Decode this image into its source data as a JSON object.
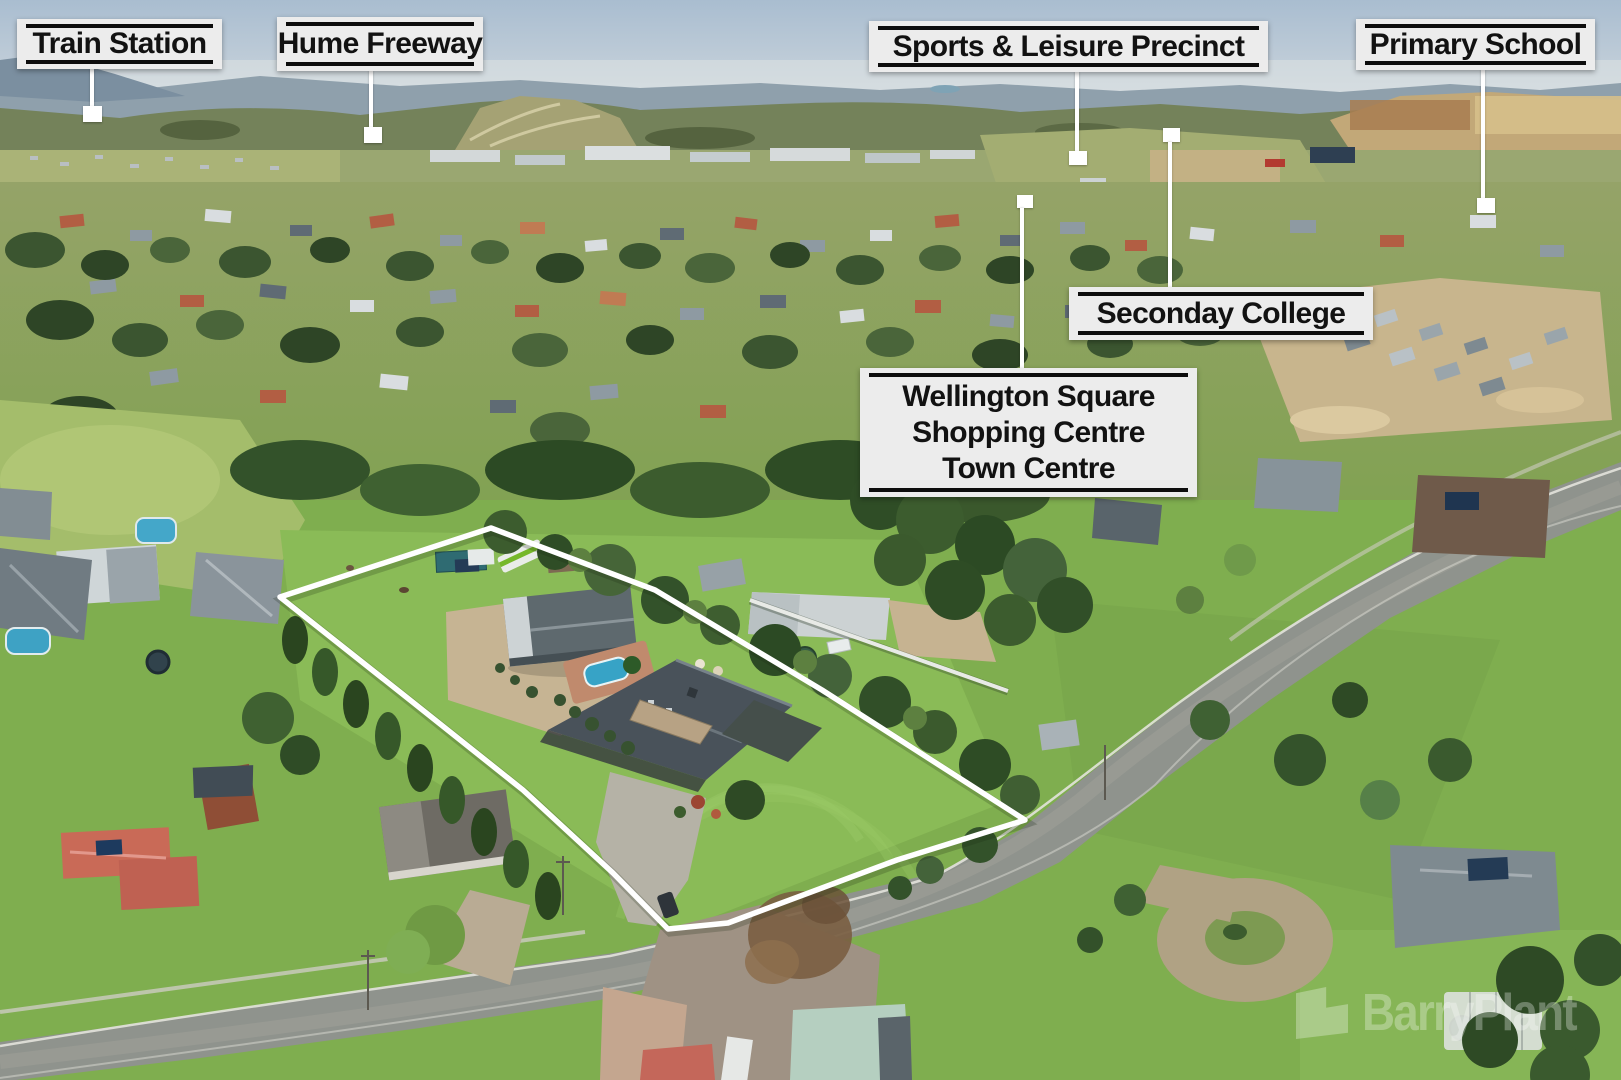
{
  "annotations": {
    "train_station": {
      "label": "Train Station"
    },
    "hume_freeway": {
      "label": "Hume Freeway"
    },
    "sports_leisure_precinct": {
      "label": "Sports & Leisure Precinct"
    },
    "primary_school": {
      "label": "Primary School"
    },
    "seconday_college": {
      "label": "Seconday College"
    },
    "wellington_square": {
      "lines": [
        "Wellington Square",
        "Shopping Centre",
        "Town Centre"
      ]
    }
  },
  "watermark": {
    "brand": "BarryPlant"
  },
  "colors": {
    "label_background": "#ececec",
    "label_text": "#121212",
    "label_rule": "#0d0d0d",
    "callout_line": "#ffffff",
    "boundary_outline": "#ffffff",
    "sky": "#aabfd2",
    "foreground_grass": "#7fae4f"
  }
}
